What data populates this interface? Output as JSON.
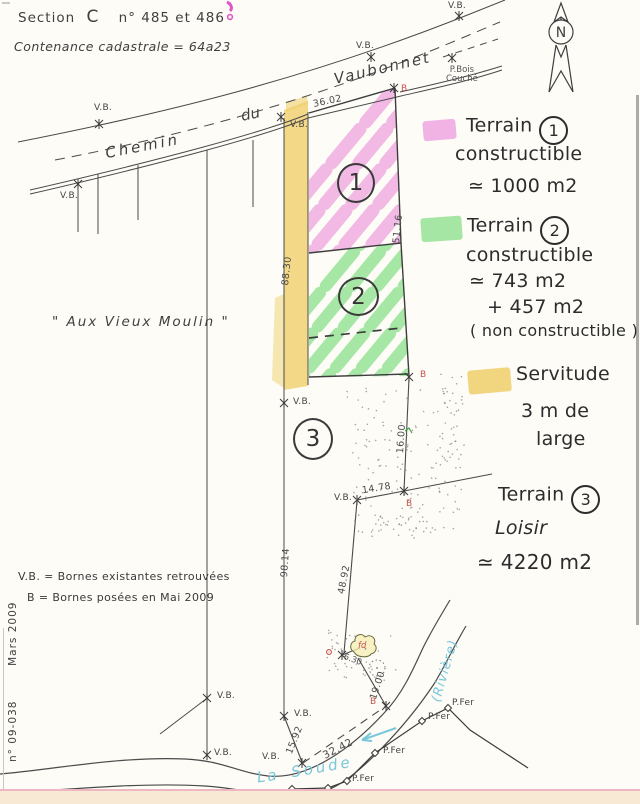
{
  "header": {
    "section_label": "Section",
    "section_value": "C",
    "parcel_numbers": "n° 485 et 486",
    "contenance": "Contenance cadastrale   =  64a23"
  },
  "north": {
    "letter": "N"
  },
  "road": {
    "word1": "Chemin",
    "word2": "du",
    "word3": "Vaubonnet"
  },
  "place_name": "\" Aux  Vieux  Moulin \"",
  "labels": {
    "vb": "V.B.",
    "b": "B",
    "pbois1": "P.Bois",
    "pbois2": "Couché",
    "pfer": "P.Fer",
    "fd": "fd"
  },
  "measurements": {
    "m36_02": "36.02",
    "m88_30": "88.30",
    "m98_14": "98.14",
    "m51_16": "51.16",
    "m16_00": "16.00",
    "m14_78": "14.78",
    "m48_92": "48.92",
    "m15_92": "15.92",
    "m32_42": "32.42",
    "m19_00": "19.00",
    "m6_30": "6.30"
  },
  "parcels": {
    "n1": "1",
    "n2": "2",
    "n3": "3"
  },
  "annotations": {
    "terrain1": {
      "word": "Terrain",
      "num": "1",
      "l2": "constructible",
      "l3": "≃ 1000 m2"
    },
    "terrain2": {
      "word": "Terrain",
      "num": "2",
      "l2": "constructible",
      "l3": "≃ 743 m2",
      "l4": "+ 457 m2",
      "l5": "( non constructible )"
    },
    "servitude": {
      "l1": "Servitude",
      "l2": "3 m de",
      "l3": "large"
    },
    "terrain3": {
      "word": "Terrain",
      "num": "3",
      "l2": "Loisir",
      "l3": "≃ 4220 m2"
    }
  },
  "legend": {
    "l1": "V.B.  =  Bornes existantes retrouvées",
    "l2": "B   =  Bornes posées en Mai 2009"
  },
  "footer": {
    "doc_number": "n° 09-038",
    "date": "Mars 2009"
  },
  "river": {
    "w1": "La",
    "w2": "Soude",
    "w3": "(Rivière)"
  },
  "colors": {
    "pink": "#eea6df",
    "green": "#8fe08f",
    "yellow": "#f0cf6a",
    "red": "#c2534e",
    "cyan": "#79c7d9"
  }
}
